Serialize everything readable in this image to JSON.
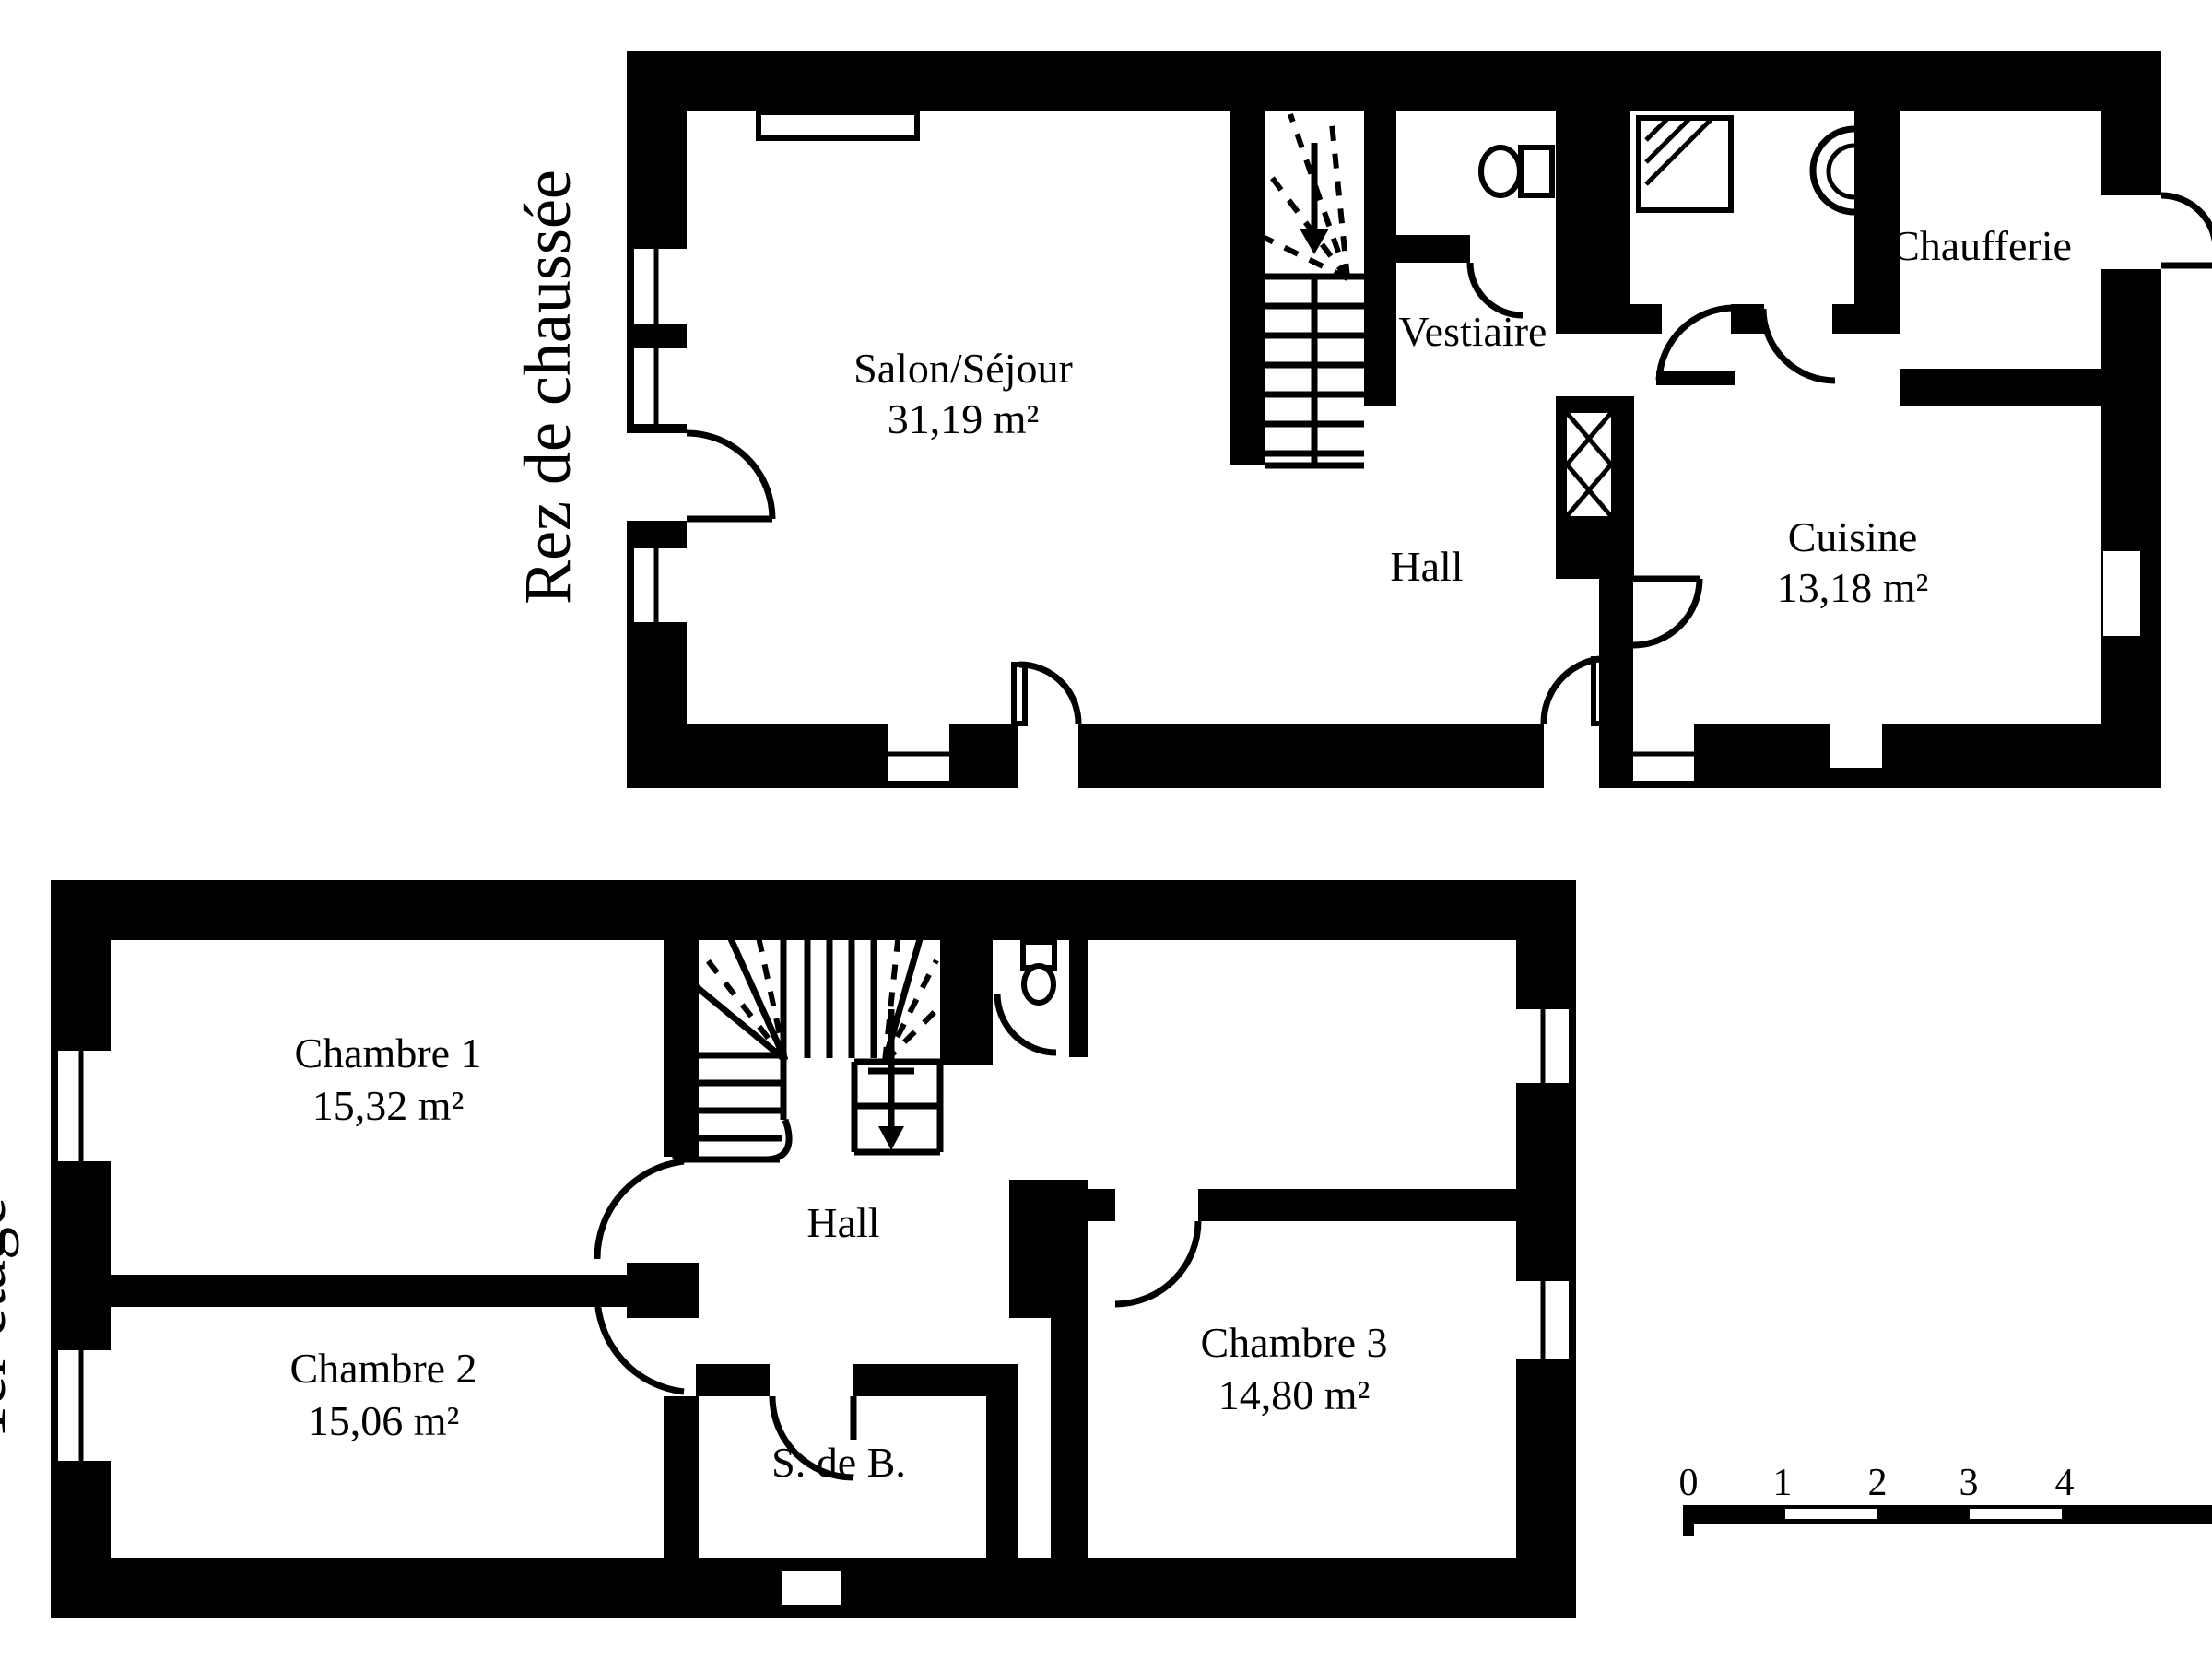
{
  "page": {
    "background": "#ffffff",
    "line_color": "#000000"
  },
  "ground_floor": {
    "title": "Rez de chaussée",
    "rooms": {
      "salon": {
        "name": "Salon/Séjour",
        "area": "31,19 m²"
      },
      "vestiaire": {
        "name": "Vestiaire"
      },
      "hall": {
        "name": "Hall"
      },
      "cuisine": {
        "name": "Cuisine",
        "area": "13,18 m²"
      },
      "chaufferie": {
        "name": "Chaufferie"
      }
    }
  },
  "first_floor": {
    "title": "1er étage",
    "rooms": {
      "chambre1": {
        "name": "Chambre 1",
        "area": "15,32 m²"
      },
      "chambre2": {
        "name": "Chambre 2",
        "area": "15,06 m²"
      },
      "chambre3": {
        "name": "Chambre 3",
        "area": "14,80 m²"
      },
      "hall": {
        "name": "Hall"
      },
      "salle_de_bain": {
        "name": "S. de B."
      }
    }
  },
  "scale_bar": {
    "ticks": [
      "0",
      "1",
      "2",
      "3",
      "4"
    ]
  }
}
